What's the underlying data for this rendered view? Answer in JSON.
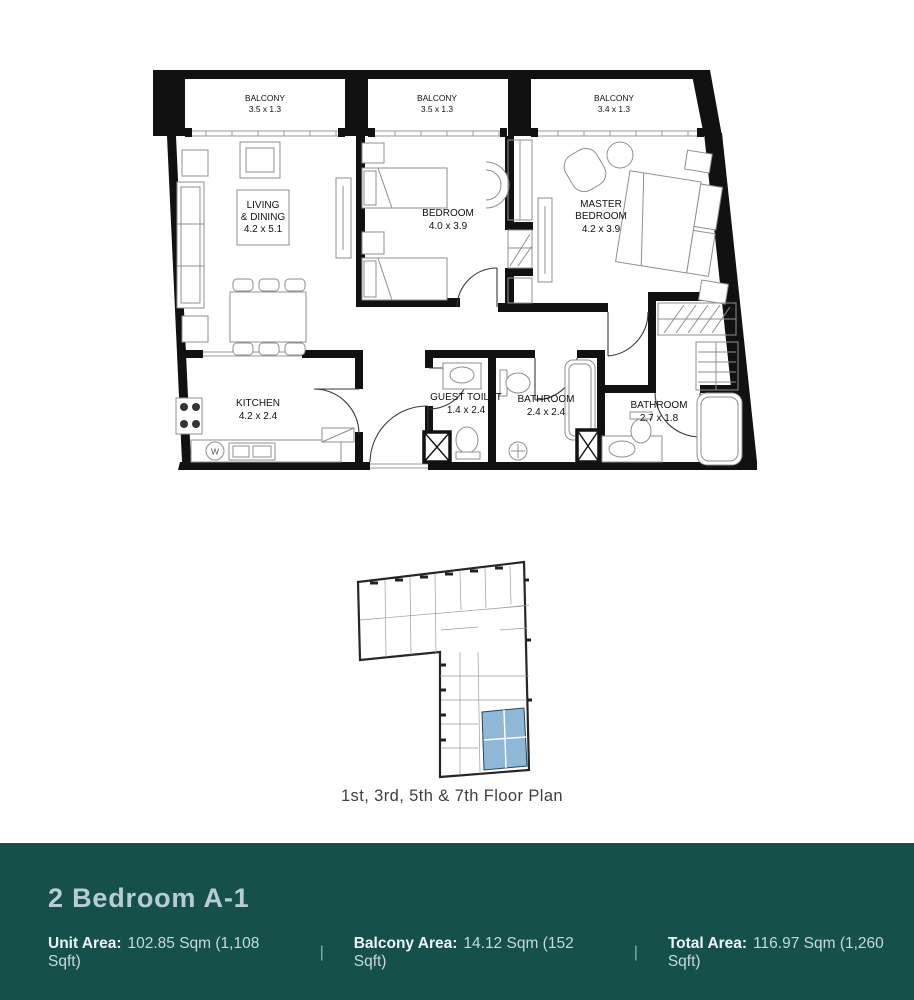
{
  "floor_plan": {
    "labels": {
      "balcony1": [
        "BALCONY",
        "3.5 x 1.3"
      ],
      "balcony2": [
        "BALCONY",
        "3.5 x 1.3"
      ],
      "balcony3": [
        "BALCONY",
        "3.4 x 1.3"
      ],
      "living": [
        "LIVING",
        "& DINING",
        "4.2 x 5.1"
      ],
      "bedroom": [
        "BEDROOM",
        "4.0 x 3.9"
      ],
      "master": [
        "MASTER",
        "BEDROOM",
        "4.2 x 3.9"
      ],
      "kitchen": [
        "KITCHEN",
        "4.2 x 2.4"
      ],
      "guest_toilet": [
        "GUEST TOILET",
        "1.4 x 2.4"
      ],
      "bathroom": [
        "BATHROOM",
        "2.4 x 2.4"
      ],
      "master_bathroom": [
        "BATHROOM",
        "2.7 x 1.8"
      ],
      "washer": "W"
    },
    "wall_color": "#111111",
    "furniture_color": "#8f8f8f"
  },
  "key_plan": {
    "caption": "1st, 3rd, 5th & 7th Floor Plan",
    "highlight_color": "#8FB8D8"
  },
  "banner": {
    "title": "2 Bedroom A-1",
    "bg_style": "background:#15504A",
    "separator": "|",
    "areas": [
      {
        "label": "Unit Area:",
        "value": "102.85 Sqm (1,108 Sqft)"
      },
      {
        "label": "Balcony Area:",
        "value": "14.12 Sqm (152 Sqft)"
      },
      {
        "label": "Total Area:",
        "value": "116.97 Sqm (1,260 Sqft)"
      }
    ]
  }
}
